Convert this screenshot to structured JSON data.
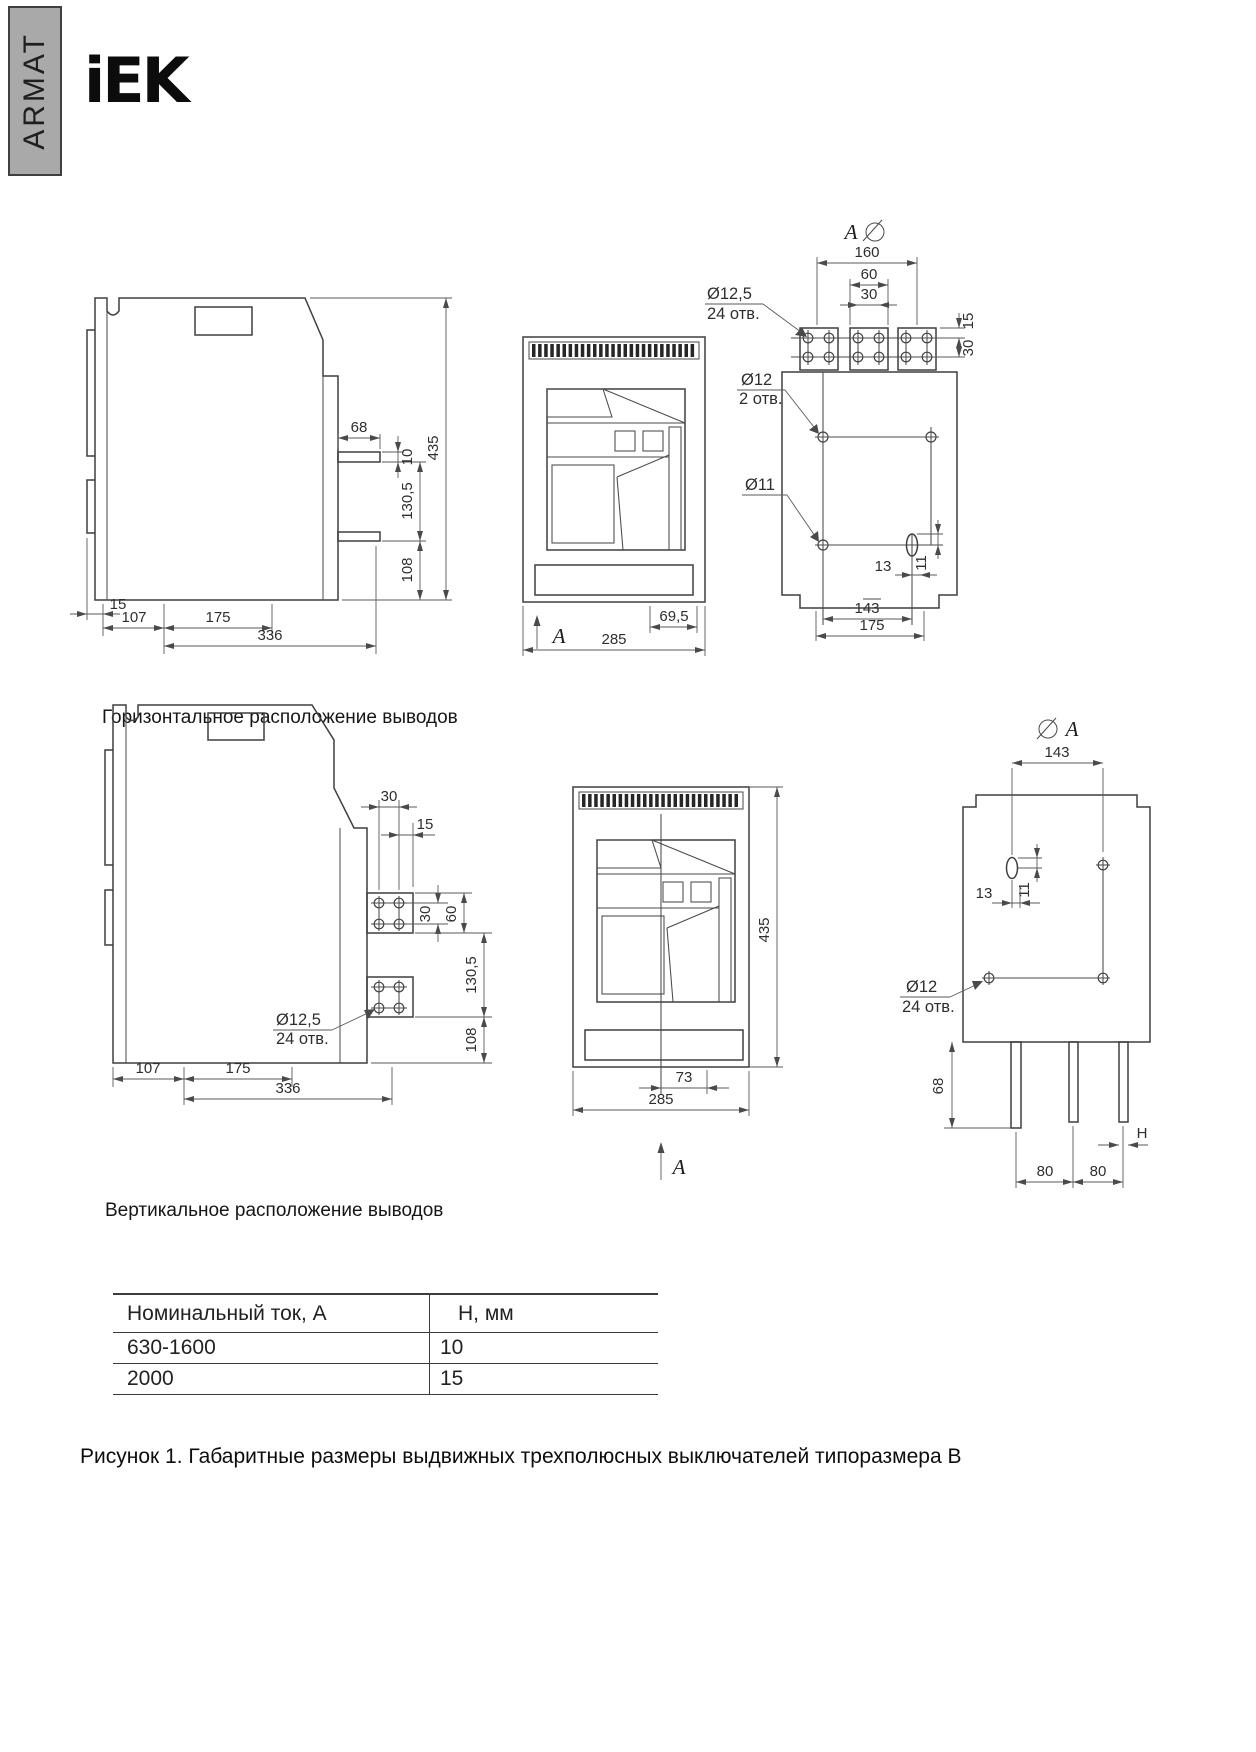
{
  "header": {
    "brand_vertical": "ARMAT",
    "logo": "iEK"
  },
  "captions": {
    "horizontal": "Горизонтальное расположение выводов",
    "vertical": "Вертикальное расположение выводов",
    "figure": "Рисунок 1. Габаритные размеры выдвижных трехполюсных выключателей типоразмера В"
  },
  "views": {
    "h_side": {
      "dims": {
        "d68": "68",
        "d10": "10",
        "d130_5": "130,5",
        "d108": "108",
        "d435": "435",
        "d15": "15",
        "d107": "107",
        "d175": "175",
        "d336": "336"
      }
    },
    "h_front": {
      "view_letter": "A",
      "dims": {
        "d69_5": "69,5",
        "d285": "285"
      }
    },
    "h_rear": {
      "view_letter": "A",
      "dims": {
        "d160": "160",
        "d60": "60",
        "d30": "30",
        "d15": "15",
        "d30b": "30",
        "d13": "13",
        "d11": "11",
        "d143": "143",
        "d175": "175"
      },
      "labels": {
        "hole_a": "Ø12,5",
        "hole_a_qty": "24 отв.",
        "hole_b": "Ø12",
        "hole_b_qty": "2 отв.",
        "hole_c": "Ø11"
      }
    },
    "v_side": {
      "dims": {
        "d30": "30",
        "d15": "15",
        "d30b": "30",
        "d60": "60",
        "d130_5": "130,5",
        "d108": "108",
        "d107": "107",
        "d175": "175",
        "d336": "336"
      },
      "labels": {
        "hole_a": "Ø12,5",
        "hole_a_qty": "24 отв."
      }
    },
    "v_front": {
      "view_letter": "A",
      "dims": {
        "d435": "435",
        "d73": "73",
        "d285": "285"
      }
    },
    "v_rear": {
      "view_letter": "A",
      "dims": {
        "d143": "143",
        "d13": "13",
        "d11": "11",
        "d68": "68",
        "d80a": "80",
        "d80b": "80",
        "dH": "H"
      },
      "labels": {
        "hole_a": "Ø12",
        "hole_a_qty": "24 отв."
      }
    }
  },
  "table": {
    "col1_header": "Номинальный ток, А",
    "col2_header": "Н, мм",
    "rows": [
      {
        "current": "630-1600",
        "h": "10"
      },
      {
        "current": "2000",
        "h": "15"
      }
    ]
  }
}
